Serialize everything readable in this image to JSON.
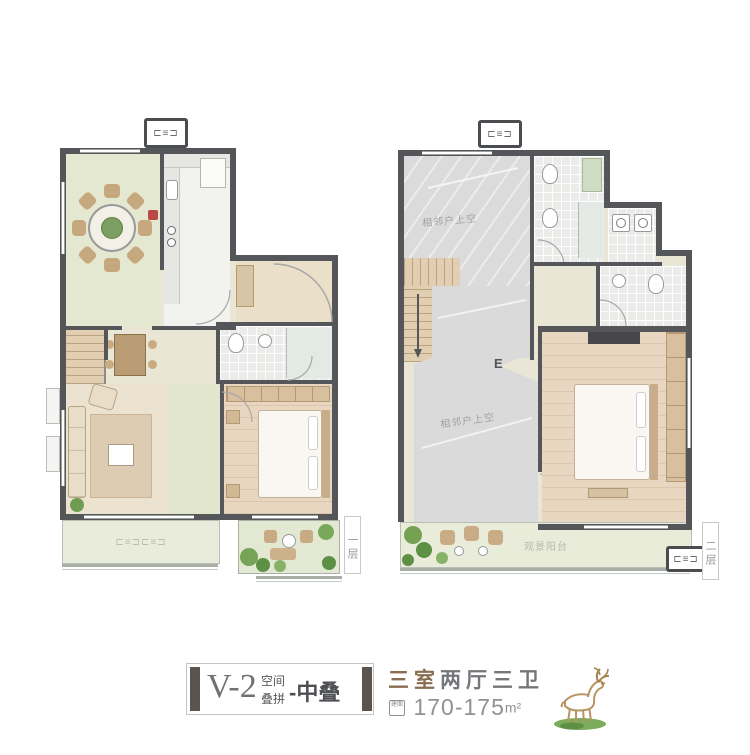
{
  "plans": {
    "first": {
      "tab": "一层",
      "marker_top": "⊏≡⊐",
      "balcony_marks": "⊏≡⊐⊏≡⊐"
    },
    "second": {
      "tab": "二层",
      "marker_top": "⊏≡⊐",
      "marker_corner": "⊏≡⊐",
      "void_upper": "相邻户上空",
      "void_center": "相邻户上空",
      "stair_label": "E",
      "balcony_label": "观景阳台"
    }
  },
  "caption": {
    "code": "V-2",
    "tag_top": "空间",
    "tag_bottom": "叠拼",
    "tag_suffix": "-中叠",
    "rooms_accent": "三室",
    "rooms_rest": "两厅三卫",
    "area_stamp": "建面",
    "area_value": "170-175",
    "area_unit": "m²"
  },
  "colors": {
    "wall": "#55565a",
    "accent_brown": "#8a6d50",
    "rooms_gray": "#74767a",
    "area_gray": "#8f9193",
    "void_gray": "#d9d9d9"
  }
}
